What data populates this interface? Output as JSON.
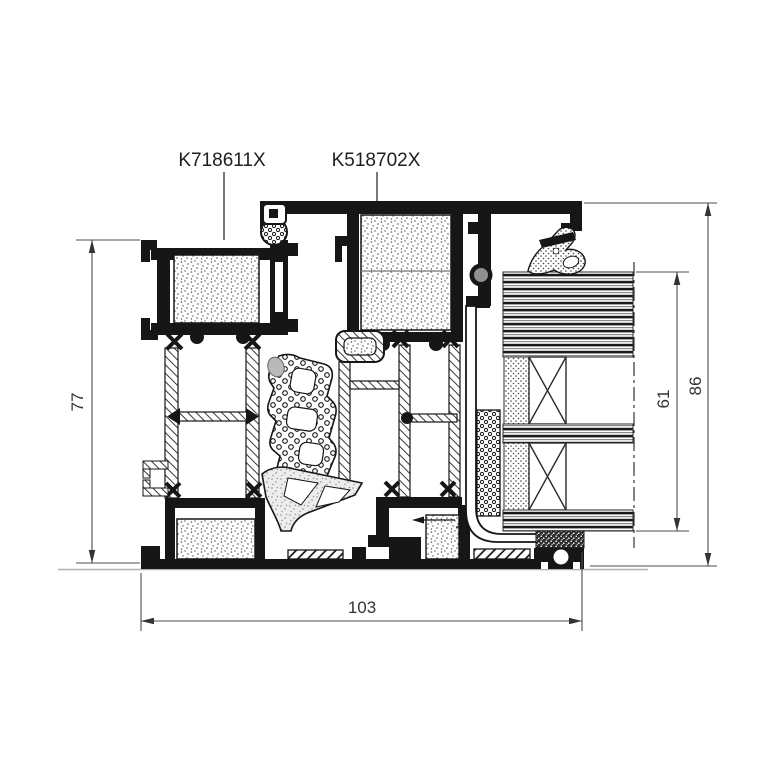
{
  "drawing": {
    "kind": "aluminium-door-threshold-cross-section"
  },
  "part_labels": {
    "left": "K718611X",
    "right": "K518702X"
  },
  "dimensions": {
    "frame_height": "77",
    "total_height": "86",
    "seal_height": "61",
    "total_width": "103"
  },
  "colors": {
    "profile_line": "#161616",
    "dimension_line": "#4d4d4d",
    "dimension_text": "#333333",
    "floor_line": "#b0b0b0",
    "gasket_gray": "#8f8f8f",
    "background": "#ffffff"
  }
}
